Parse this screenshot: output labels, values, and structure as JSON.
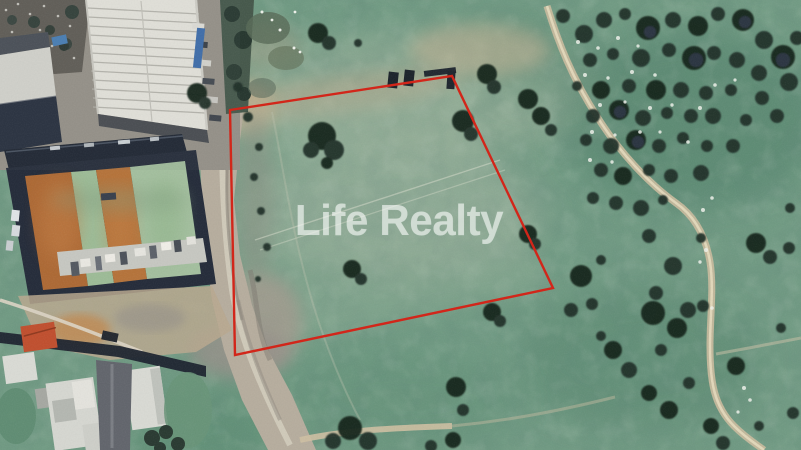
{
  "watermark": {
    "text": "Life Realty",
    "color": "#ffffff",
    "opacity": 0.55
  },
  "boundary": {
    "color": "#d2261a",
    "stroke_width": 2.4,
    "points": "230,110 452,76 553,288 235,355"
  },
  "scene": {
    "kind": "satellite-aerial-photo",
    "subject": "open land parcel outlined in red",
    "surroundings": {
      "northwest": "white-roof warehouse and walled storage yard with orange and green sections",
      "southwest": "small white houses with an orange-roof house and gray street",
      "west": "wide gravel road running north-south",
      "east": "tree-dotted pasture with winding dirt trail"
    },
    "palette": {
      "field_green": "#729b84",
      "deep_teal": "#4e7e68",
      "pale_sage": "#a2b39e",
      "dirt_tan": "#c7b698",
      "road_gray": "#b4aca0",
      "tree_dark": "#20302a",
      "roof_white": "#eae8e0",
      "building_navy": "#242b39",
      "yard_orange": "#b06a36",
      "boundary_red": "#d2261a"
    }
  }
}
